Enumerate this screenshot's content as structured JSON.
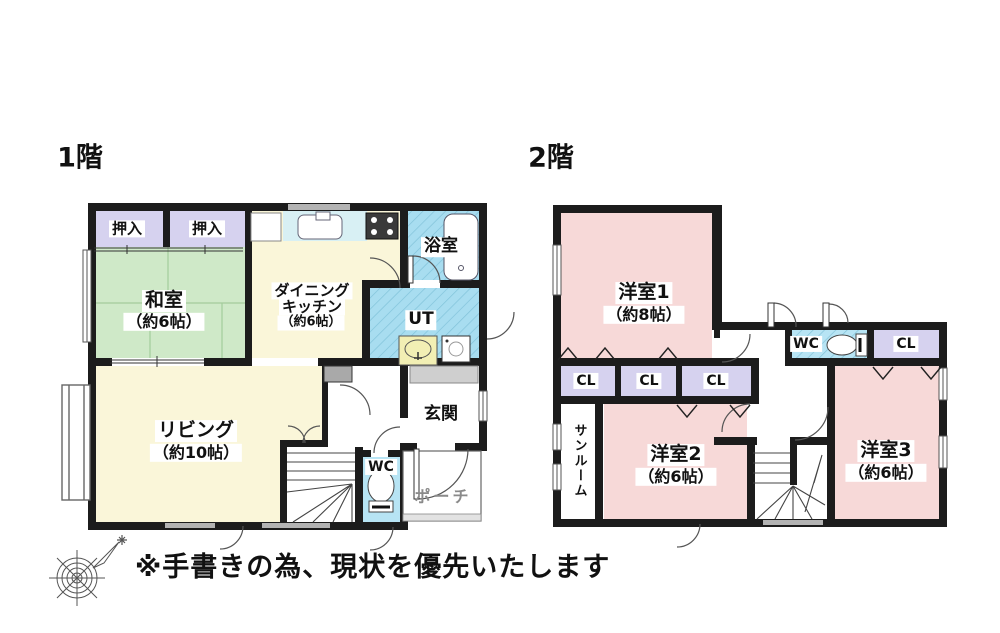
{
  "floor1": {
    "title": "1階",
    "rooms": {
      "oshiire1": "押入",
      "oshiire2": "押入",
      "washitsu": {
        "name": "和室",
        "size": "（約6帖）"
      },
      "dining_kitchen": {
        "name1": "ダイニング",
        "name2": "キッチン",
        "size": "（約6帖）"
      },
      "bathroom": "浴室",
      "utility": "UT",
      "living": {
        "name": "リビング",
        "size": "（約10帖）"
      },
      "entrance": "玄関",
      "wc": "WC",
      "porch": "ポーチ"
    }
  },
  "floor2": {
    "title": "2階",
    "rooms": {
      "yoshitsu1": {
        "name": "洋室1",
        "size": "（約8帖）"
      },
      "closet1": "CL",
      "closet2": "CL",
      "closet3": "CL",
      "closet4": "CL",
      "wc": "WC",
      "sunroom": "サンルーム",
      "yoshitsu2": {
        "name": "洋室2",
        "size": "（約6帖）"
      },
      "yoshitsu3": {
        "name": "洋室3",
        "size": "（約6帖）"
      }
    }
  },
  "note": "※手書きの為、現状を優先いたします",
  "icons": [
    "compass-icon",
    "bathtub-icon",
    "toilet-icon",
    "kitchen-sink-icon",
    "stove-icon",
    "wash-basin-icon",
    "washing-machine-icon",
    "stairs-icon",
    "door-swing-icon",
    "window-icon"
  ],
  "colors": {
    "wall": "#1c1c1c",
    "tatami_green": "#cfe9c8",
    "closet_lavender": "#d6d2ef",
    "room_yellow": "#faf6d9",
    "wet_blue": "#a8ddf0",
    "wet_blue_light": "#b7e4f4",
    "room_pink": "#f7d9d8",
    "counter_cyan": "#d8f0f4",
    "basin_yellow": "#f2efb4",
    "window_gray": "#b3b3b3",
    "porch_text": "#8a8a8a"
  }
}
